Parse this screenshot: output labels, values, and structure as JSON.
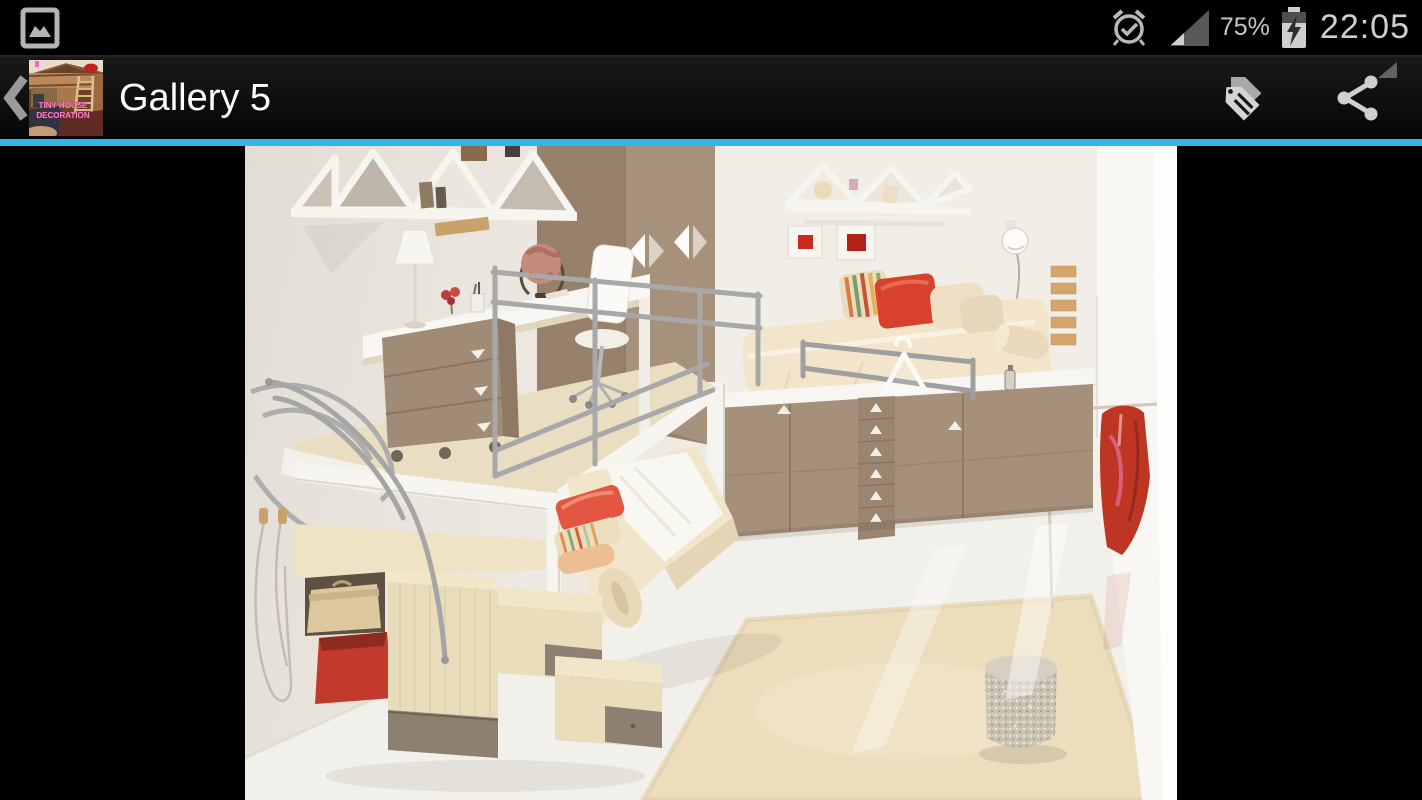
{
  "status_bar": {
    "time": "22:05",
    "battery_percent": "75%"
  },
  "action_bar": {
    "title": "Gallery 5",
    "accent_color": "#33b5e5",
    "thumbnail": {
      "line1": "TINY HOUSE",
      "line2": "DECORATION"
    }
  },
  "icons": {
    "status_left": "image-notification",
    "status_right": [
      "alarm-on",
      "signal-strength",
      "battery-charging"
    ],
    "action_left": "back-chevron",
    "action_right": [
      "edit-tags",
      "share"
    ]
  },
  "photo": {
    "content": "Kids loft bedroom: white desk with lamp and globe, taupe drawer unit, metal loft railings, wooden storage staircase with red bin and basket, lower bed with red and striped pillows, raised bed on taupe chest with triangular handles, zigzag wall shelves, two red framed pictures, hanging red clothes, cream shag rug and sparkly pouf"
  }
}
